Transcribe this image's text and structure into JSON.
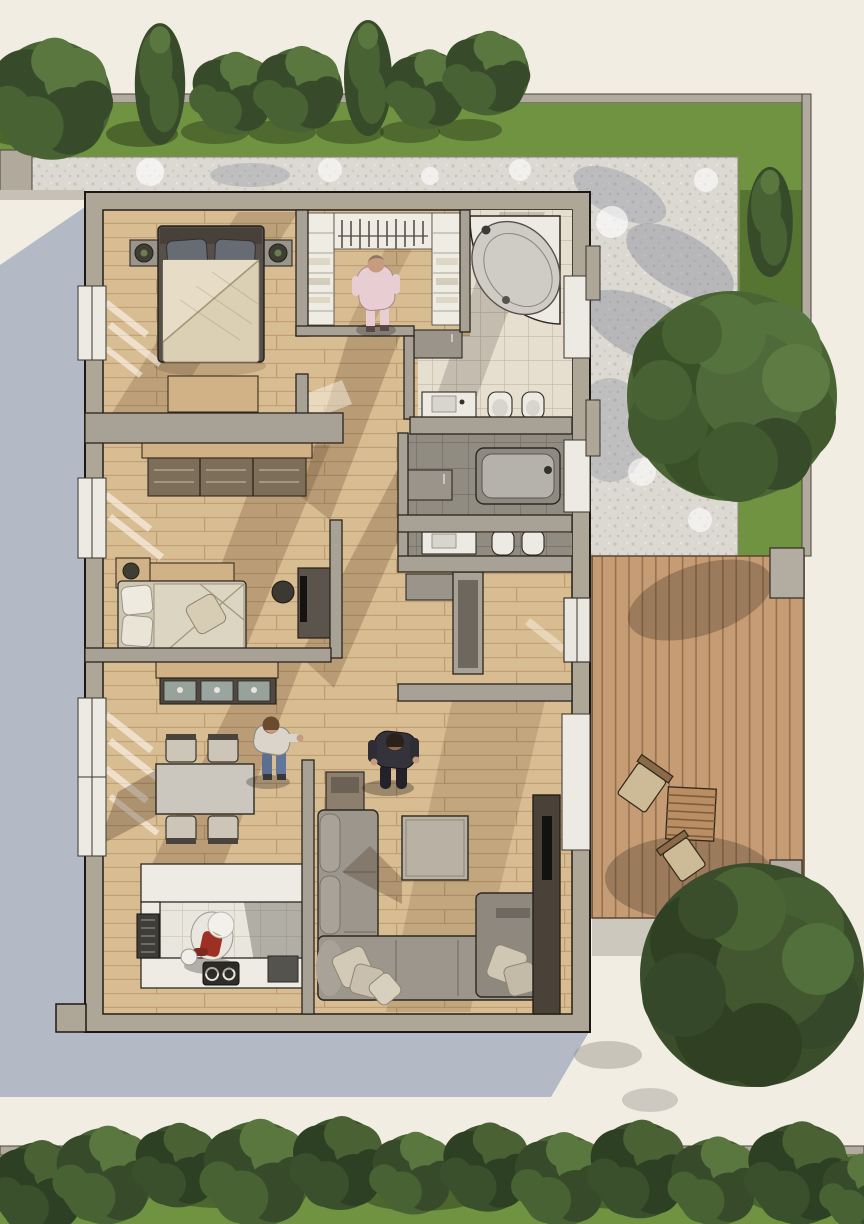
{
  "scene": {
    "title": "top-down-3d-floor-plan-render",
    "setting": "single-storey house with garden, gravel path and wooden deck"
  },
  "colors": {
    "background": "#f1ede2",
    "house_shadow": "#b4b9c6",
    "grass": "#6f9340",
    "gravel_base": "#dcd9d3",
    "boundary_wall": "#b1aa9e",
    "wall": "#aea798",
    "wood_floor": "#d9bd92",
    "deck": "#c59c74",
    "tile_beige": "#e6dfd0",
    "tile_gray": "#918c82",
    "fixture_white": "#eceae2",
    "sofa": "#9c968c",
    "duvet": "#dbcfb4",
    "media_wall": "#4a4138",
    "apron_red": "#9e2f24",
    "pajama_pink": "#e8cdd2",
    "tree_dark": "#374b2b",
    "tree_light": "#5a7740"
  },
  "rooms": [
    {
      "id": "bedroom",
      "furniture": [
        "double-bed",
        "nightstand-left",
        "nightstand-right",
        "table-lamps",
        "bench"
      ]
    },
    {
      "id": "walk-in-closet",
      "furniture": [
        "shelf-column-left",
        "hanging-rail",
        "shelf-column-right",
        "dresser"
      ]
    },
    {
      "id": "bathroom-top",
      "furniture": [
        "corner-bathtub",
        "vanity-sink",
        "toilet",
        "bidet"
      ]
    },
    {
      "id": "bathroom-middle",
      "furniture": [
        "bathtub",
        "cabinet"
      ]
    },
    {
      "id": "bathroom-lower",
      "furniture": [
        "vanity-sink",
        "toilet",
        "bidet"
      ]
    },
    {
      "id": "kids-room",
      "furniture": [
        "storage-bench",
        "single-bed",
        "nightstand-lamp",
        "desk-tv-unit",
        "chair"
      ]
    },
    {
      "id": "hallway",
      "furniture": [
        "dresser"
      ]
    },
    {
      "id": "entry",
      "furniture": [
        "storage-partition",
        "cabinet"
      ]
    },
    {
      "id": "dining-room",
      "furniture": [
        "dining-table",
        "four-chairs",
        "glass-sideboard"
      ]
    },
    {
      "id": "kitchen",
      "furniture": [
        "u-shaped-counter",
        "cooktop",
        "sink-unit"
      ]
    },
    {
      "id": "living-room",
      "furniture": [
        "corner-sofa",
        "chaise",
        "scatter-pillows",
        "coffee-table",
        "side-table",
        "tv-media-wall"
      ]
    }
  ],
  "people": [
    {
      "id": "person-closet",
      "desc": "person in pink pajamas in walk-in closet"
    },
    {
      "id": "person-dining",
      "desc": "person in light top and jeans walking near dining area"
    },
    {
      "id": "person-living",
      "desc": "person in dark suit walking in living room"
    },
    {
      "id": "person-kitchen",
      "desc": "chef with white hat and red apron at kitchen counter"
    }
  ],
  "exterior": {
    "deck": {
      "id": "wooden-deck",
      "furniture": [
        "deck-chair-1",
        "slatted-table",
        "deck-chair-2",
        "pillar",
        "step"
      ]
    },
    "garden": {
      "gravel_path": true,
      "lawn_strip_top": true,
      "lawn_strip_right": true,
      "lawn_strip_bottom": true,
      "tree_row_top_count": 7,
      "tree_row_bottom_count": 12,
      "large_tree_right": 1,
      "large_tree_bottom_right": 1,
      "columnar_tree_right": 1
    }
  }
}
